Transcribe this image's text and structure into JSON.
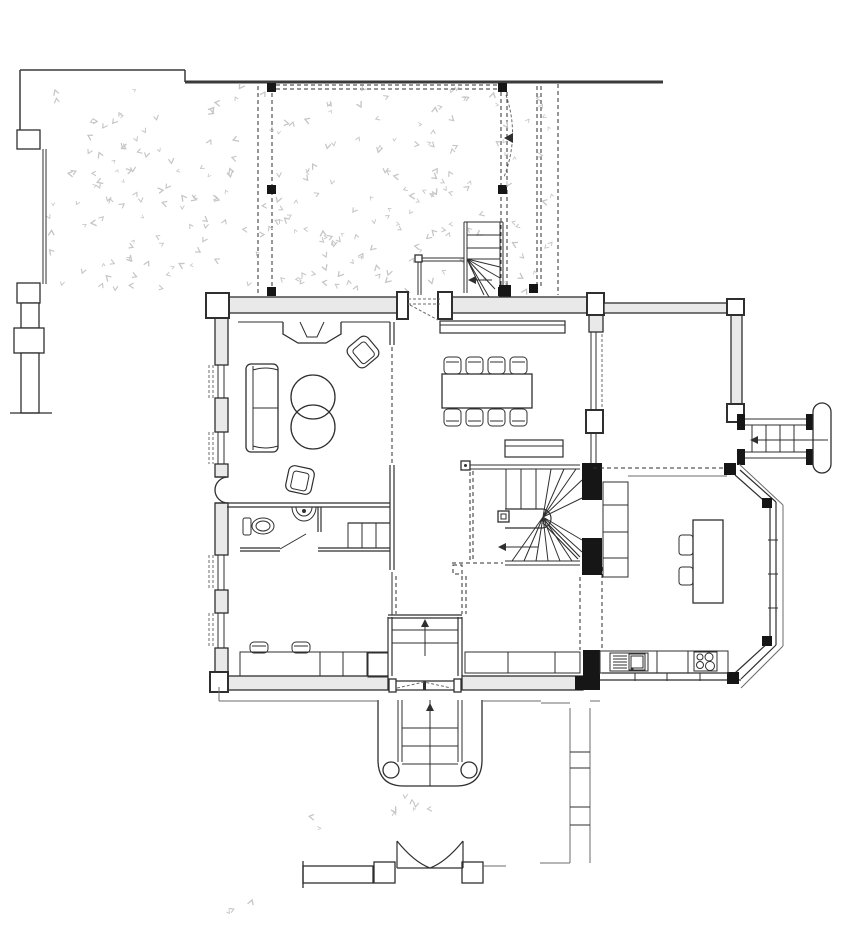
{
  "drawing": {
    "kind": "architectural-ground-floor-plan",
    "background": "#ffffff"
  },
  "palette": {
    "paper": "#ffffff",
    "line": "#2f2f2f",
    "soft": "#6b6b6b",
    "site": "#3a3a3a",
    "wallfill": "#e9e9e9",
    "dark": "#161616",
    "stipple": "#c5c5c5"
  },
  "stipple": {
    "seed": 7,
    "regions": [
      {
        "x": 48,
        "y": 88,
        "w": 502,
        "h": 202,
        "count": 250
      },
      {
        "x": 385,
        "y": 795,
        "w": 60,
        "h": 22,
        "count": 7
      },
      {
        "x": 228,
        "y": 896,
        "w": 40,
        "h": 16,
        "count": 3
      },
      {
        "x": 310,
        "y": 818,
        "w": 30,
        "h": 14,
        "count": 2
      }
    ]
  },
  "components": {
    "site": [
      "boundary-fence",
      "fence-posts",
      "site-line"
    ],
    "garden": [
      "pergola-posts",
      "gravel-terrace",
      "garden-gate",
      "garden-path"
    ],
    "house": [
      "living-room",
      "dining-room",
      "hall",
      "wc",
      "kitchen-bay",
      "terrace-wing"
    ],
    "furniture": [
      "sofa",
      "round-table",
      "armchair",
      "dining-table",
      "dining-chair",
      "sideboard",
      "kitchen-island",
      "stool",
      "sink",
      "stove",
      "toilet",
      "basin"
    ],
    "circulation": [
      "entry-winder-stair",
      "spiral-stair",
      "porch-stair",
      "terrace-stair",
      "vestibule-steps"
    ]
  }
}
